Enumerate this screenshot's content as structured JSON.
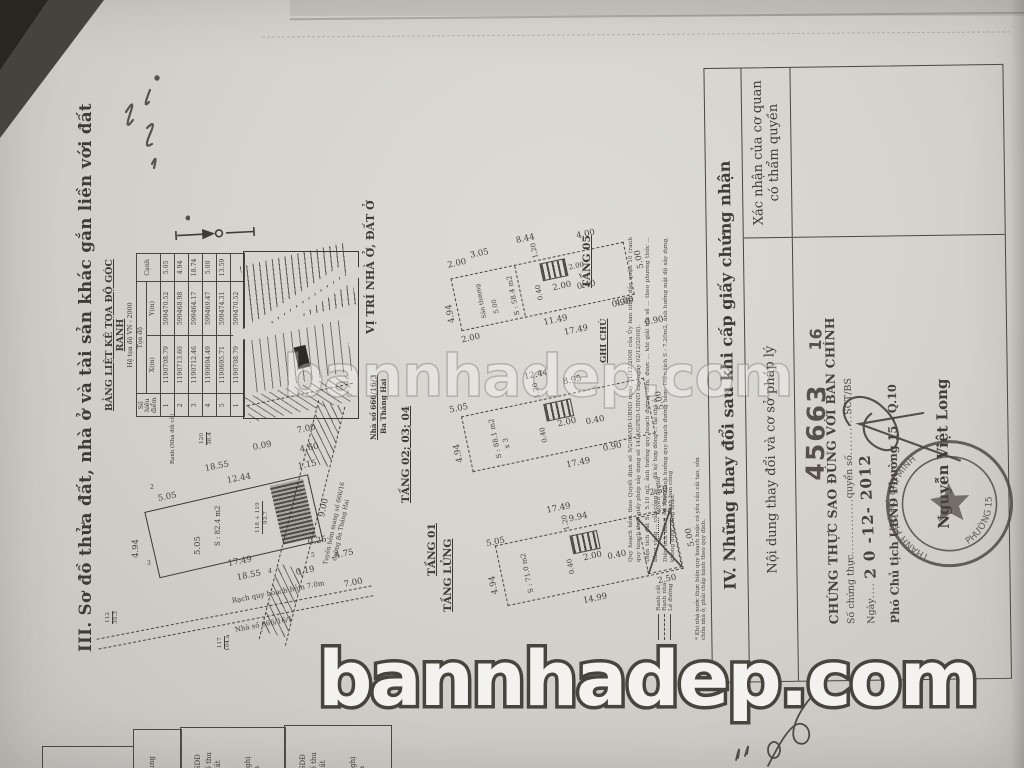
{
  "watermark": "bannhadep.com",
  "doc": {
    "section3_title": "III. Sơ đồ thửa đất, nhà ở và tài sản khác gắn liền với đất",
    "coord_table": {
      "title": "BẢNG LIỆT KÊ  TỌA ĐỘ GÓC RANH",
      "subtitle": "Hệ tọa độ VN - 2000",
      "col_point_1": "Số hiệu",
      "col_point_2": "điểm",
      "col_coords": "Tọa độ",
      "col_x": "X(m)",
      "col_y": "Y(m)",
      "col_edge": "Cạnh",
      "rows": [
        {
          "pt": "1",
          "x": "1190708.79",
          "y": "599470.52",
          "edge": "5.05"
        },
        {
          "pt": "2",
          "x": "1190713.60",
          "y": "599468.98",
          "edge": "4.94"
        },
        {
          "pt": "3",
          "x": "1190712.46",
          "y": "599464.17",
          "edge": "18.74"
        },
        {
          "pt": "4",
          "x": "1190694.49",
          "y": "599469.47",
          "edge": "5.00"
        },
        {
          "pt": "5",
          "x": "1190695.71",
          "y": "599474.31",
          "edge": "13.59"
        },
        {
          "pt": "1",
          "x": "1190708.79",
          "y": "599470.52",
          "edge": ""
        }
      ]
    },
    "map": {
      "label": "VỊ TRÍ NHÀ Ở, ĐẤT Ở",
      "house_no": "Nhà số 666/16/3",
      "street": "Ba Tháng Hai"
    },
    "alley": {
      "line1": "Tuyến hẻm mang số 666/16",
      "line2": "đường Ba Tháng Hai",
      "canal": "Rạch quy hoạch hẻm 7.0m",
      "house_below": "Nhà số 666/16/1",
      "ranh": "Ranh (Nhà đổi cũ)"
    },
    "lots": {
      "l117": "117",
      "l117a": "104.a",
      "l120": "120",
      "l120a": "38.4",
      "l112": "112",
      "l112a": "35.3",
      "lmain": "118 + 119",
      "lmaina": "93.7"
    },
    "plans": {
      "t01": {
        "label": "TẦNG 01",
        "area": "S : 82.4 m2",
        "dims": {
          "a": "18.55",
          "b": "12.44",
          "c": "5.05",
          "d": "4.94",
          "e": "5.05",
          "f": "17.49",
          "g": "18.55",
          "h": "0.09",
          "i": "7.00",
          "j": "4.60",
          "k": "1.15",
          "l": "9.00",
          "m": "0.25",
          "n": "4.75",
          "o": "0.19",
          "p": "7.00",
          "corners": [
            "1",
            "2",
            "3",
            "4",
            "5"
          ]
        }
      },
      "tlg": {
        "label": "TẦNG LỬNG",
        "area": "S : 71.0 m2",
        "dims": {
          "a": "17.49",
          "b": "9.94",
          "c": "2.50",
          "d": "5.05",
          "e": "4.94",
          "f": "1.20",
          "g": "0.40",
          "h": "2.00",
          "i": "0.40",
          "j": "14.99",
          "k": "2.50",
          "l": "5.00"
        }
      },
      "t234": {
        "label": "TẦNG 02; 03; 04",
        "area": "S : 88.1 m2",
        "mult": "x 3",
        "dims": {
          "a": "5.05",
          "b": "12.44",
          "c": "8.95",
          "d": "4.94",
          "e": "1.20",
          "f": "0.40",
          "g": "2.00",
          "h": "0.40",
          "i": "17.49",
          "j": "5.00",
          "k": "0.90"
        }
      },
      "t05": {
        "label": "TẦNG 05",
        "area": "S : 58.4 m2",
        "terrace": "Sân thượng",
        "terrace_w": "5.00",
        "dims": {
          "a": "2.00",
          "b": "3.05",
          "c": "8.44",
          "d": "4.00",
          "e": "4.94",
          "f": "2.00",
          "g": "1.20",
          "h": "0.40",
          "i": "2.00",
          "j": "0.40",
          "k": "11.49",
          "l": "17.49",
          "m": "4.00",
          "n": "5.00",
          "o": "0.90",
          "p": "0.90",
          "q": "2.00"
        }
      }
    },
    "notes": {
      "header": "GHI CHÚ",
      "items": [
        "Quy hoạch hẻm theo Quyết định số 9/2/08/QĐ-UBND ngày 31/12/2008 của Ủy ban nhân dân quận 10 (ranh quy hoạch theo giấy phép xây dựng số 1414/GPXD-UBND cấp ngày 02/12/2008).",
        "Diện tích đất S : 5.10 m2, ảnh hưởng quy hoạch đường hẻm, được ... khi giải tỏa sẽ ... theo phương thức ... bằng vàng ... của công ty ... đã ký hợp đồng ... tại nhà ở.",
        "Diện tích đất S : 0.70m2 ảnh hưởng quy hoạch đường hẻm; Diện tích S : 7.20m2, ảnh hưởng mật độ xây dựng, không được công nhận."
      ]
    },
    "legend": {
      "colA": [
        "Ranh cắt",
        "Ranh nhà",
        "Lề đường"
      ],
      "colB": [
        "Tuyến lộ giới",
        "Lề đường",
        "Ranh ban công"
      ],
      "footnote": "* Khi nhà nước thực hiện quy hoạch hoặc có yêu cầu cải tạo, sửa chữa nhà ở, phải chấp hành theo quy định."
    },
    "section4": {
      "title": "IV. Những thay đổi sau khi cấp giấy chứng nhận",
      "col1": "Nội dung thay đổi và cơ sở pháp lý",
      "col2a": "Xác nhận của cơ quan",
      "col2b": "có thẩm quyền"
    },
    "stamp": {
      "number": "45663",
      "number2": "16",
      "line1": "CHỨNG THỰC SAO ĐÚNG VỚI BẢN CHÍNH",
      "line2a": "Số chứng thực",
      "line2b": "quyển số",
      "line2c": "SCT/BS",
      "ngay": "Ngày",
      "date": "2 0  -12-  2012",
      "line4": "Phó Chủ tịch UBND Phường 15 - Q.10",
      "signer": "Nguyễn Việt Long",
      "seal_top": "THÀNH PHỐ HỒ CHÍ MINH",
      "seal_bottom": "PHƯỜNG 15"
    },
    "bottom_fragments": {
      "b1": [
        "dung"
      ],
      "b2": [
        "QSDĐ",
        "số thu",
        "đất",
        "Nghị",
        "a"
      ]
    }
  }
}
